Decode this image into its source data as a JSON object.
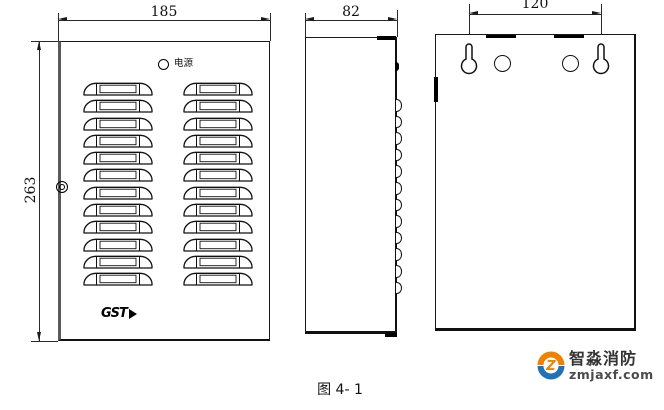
{
  "figure": {
    "caption": "图 4- 1"
  },
  "views": {
    "front": {
      "width_dim": "185",
      "height_dim": "263",
      "led_label": "电源",
      "logo_text": "GST",
      "vent_rows": 12,
      "vent_columns": 2
    },
    "side": {
      "width_dim": "82",
      "bump_count": 12
    },
    "back": {
      "hole_spacing_dim": "120",
      "keyhole_count": 2,
      "round_hole_count": 2
    }
  },
  "watermark": {
    "brand": "智淼消防",
    "site": "zmjaxf.com",
    "orange": "#ef8200",
    "blue": "#2273b5"
  },
  "colors": {
    "line": "#1a1a1a",
    "dim_text": "#111111"
  }
}
